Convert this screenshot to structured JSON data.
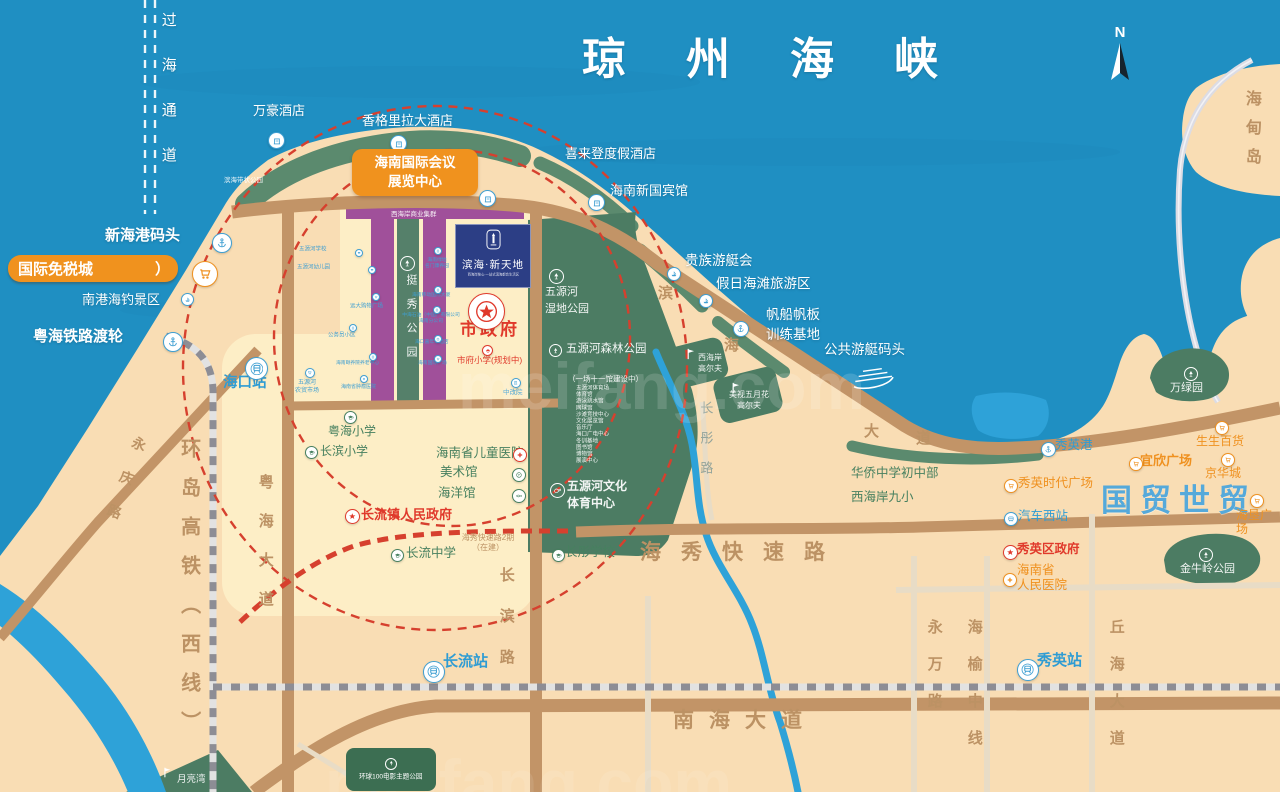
{
  "colors": {
    "blue": "#3f9fd2",
    "green": "#47805f",
    "og": "#ef9120",
    "red": "#e0392b",
    "white": "#ffffff",
    "sea": "#1f8fc2",
    "land": "#f9ddb4",
    "park": "#4c7c63",
    "purple": "#a0509a",
    "road": "#c29467",
    "accent_orange": "#f0921e"
  },
  "compass": {
    "label": "N"
  },
  "project": {
    "title": "滨海·新天地",
    "tagline": "西海岸核心·一站式滨海都会生活区"
  },
  "badges": {
    "convention": {
      "t": "海南国际会议\n展览中心"
    },
    "dutyfree": {
      "t": "国际免税城",
      "arrow": "）"
    },
    "huanqiu": {
      "t": "环球100电影主题公园"
    }
  },
  "texts": [
    {
      "n": "qiongzhou-strait",
      "t": "琼州海峡",
      "x": 582,
      "y": 34,
      "s": 44,
      "c": "w",
      "b": 1,
      "ls": 60
    },
    {
      "n": "cross-sea-channel",
      "t": "过海通道",
      "x": 159,
      "y": 12,
      "s": 15,
      "c": "w",
      "v": 1,
      "ls": 30
    },
    {
      "n": "wanhao-hotel",
      "t": "万豪酒店",
      "x": 253,
      "y": 103,
      "s": 13,
      "c": "w"
    },
    {
      "n": "shangri-la-hotel",
      "t": "香格里拉大酒店",
      "x": 362,
      "y": 113,
      "s": 13,
      "c": "w"
    },
    {
      "n": "sheraton-hotel",
      "t": "喜来登度假酒店",
      "x": 565,
      "y": 146,
      "s": 13,
      "c": "w"
    },
    {
      "n": "new-guobin-hotel",
      "t": "海南新国宾馆",
      "x": 610,
      "y": 183,
      "s": 13,
      "c": "w"
    },
    {
      "n": "binhai-belt-park",
      "t": "滨海带状公园",
      "x": 224,
      "y": 176,
      "s": 6.5,
      "c": "wt"
    },
    {
      "n": "xinhai-port",
      "t": "新海港码头",
      "x": 105,
      "y": 227,
      "s": 15,
      "c": "w",
      "b": 1
    },
    {
      "n": "nangang-fishing-area",
      "t": "南港海钓景区",
      "x": 82,
      "y": 292,
      "s": 13,
      "c": "w"
    },
    {
      "n": "yuehai-rail-ferry",
      "t": "粤海铁路渡轮",
      "x": 33,
      "y": 328,
      "s": 15,
      "c": "w",
      "b": 1
    },
    {
      "n": "haikou-station",
      "t": "海口站",
      "x": 223,
      "y": 375,
      "s": 14.5,
      "c": "tb",
      "b": 1
    },
    {
      "n": "wuyuanhe-market",
      "t": "五源河\n农贸市场",
      "x": 288,
      "y": 378,
      "s": 6,
      "c": "bl",
      "w": 38,
      "lh": 1.35
    },
    {
      "n": "noble-yacht-club",
      "t": "贵族游艇会",
      "x": 685,
      "y": 253,
      "s": 13.5,
      "c": "w"
    },
    {
      "n": "holiday-beach-area",
      "t": "假日海滩旅游区",
      "x": 716,
      "y": 276,
      "s": 13.5,
      "c": "w"
    },
    {
      "n": "sailing-base",
      "t": "帆船帆板\n训练基地",
      "x": 766,
      "y": 305,
      "s": 13.5,
      "c": "w",
      "lh": 1.5
    },
    {
      "n": "public-yacht-wharf",
      "t": "公共游艇码头",
      "x": 824,
      "y": 342,
      "s": 13.5,
      "c": "w"
    },
    {
      "n": "west-coast-golf",
      "t": "西海岸\n高尔夫",
      "x": 694,
      "y": 352,
      "s": 8,
      "c": "wt",
      "w": 32,
      "lh": 1.4
    },
    {
      "n": "meishi-mayflower-golf",
      "t": "美视五月花\n高尔夫",
      "x": 726,
      "y": 389,
      "s": 8,
      "c": "wt",
      "w": 46,
      "lh": 1.4
    },
    {
      "n": "west-coast-business",
      "t": "西海岸商业集群",
      "x": 391,
      "y": 210,
      "s": 6.5,
      "c": "wt"
    },
    {
      "n": "tingxiu-park",
      "t": "挺秀公园",
      "x": 404,
      "y": 274,
      "s": 11,
      "c": "wt",
      "v": 1,
      "ls": 13
    },
    {
      "n": "wuyuanhe-wetland-park",
      "t": "五源河\n湿地公园",
      "x": 545,
      "y": 284,
      "s": 11,
      "c": "wt",
      "lh": 1.55
    },
    {
      "n": "wuyuanhe-forest-park",
      "t": "五源河森林公园",
      "x": 566,
      "y": 343,
      "s": 11.5,
      "c": "wt"
    },
    {
      "n": "stadium-note",
      "t": "（一场十一馆建设中）",
      "x": 568,
      "y": 375,
      "s": 7.5,
      "c": "wt"
    },
    {
      "n": "stadium-list",
      "t": "五源河体育场\n体育馆\n游泳跳水馆\n网球馆\n沙滩竞技中心\n文化展览馆\n音乐厅\n海口广电中心\n冬训基地\n图书馆\n博物馆\n展演中心",
      "x": 576,
      "y": 385,
      "s": 5.5,
      "c": "wt",
      "lh": 1.2
    },
    {
      "n": "wenti-center",
      "t": "五源河文化\n体育中心",
      "x": 567,
      "y": 478,
      "s": 12,
      "c": "wt",
      "b": 1,
      "lh": 1.45
    },
    {
      "n": "city-government",
      "t": "市政府",
      "x": 460,
      "y": 320,
      "s": 17,
      "c": "rd",
      "b": 1,
      "ls": 3
    },
    {
      "n": "shifu-primary",
      "t": "市府小学(规划中)",
      "x": 457,
      "y": 355,
      "s": 8.5,
      "c": "rd"
    },
    {
      "n": "zhonggaiyuan",
      "t": "中改院",
      "x": 503,
      "y": 388,
      "s": 6.5,
      "c": "bl"
    },
    {
      "n": "children-hospital",
      "t": "海南省儿童医院",
      "x": 436,
      "y": 446,
      "s": 12.5,
      "c": "gn"
    },
    {
      "n": "art-museum",
      "t": "美术馆",
      "x": 440,
      "y": 465,
      "s": 12.5,
      "c": "gn"
    },
    {
      "n": "ocean-museum",
      "t": "海洋馆",
      "x": 438,
      "y": 486,
      "s": 12.5,
      "c": "gn"
    },
    {
      "n": "changliu-town-gov",
      "t": "长流镇人民政府",
      "x": 361,
      "y": 507,
      "s": 13,
      "c": "rd",
      "b": 1
    },
    {
      "n": "yuehai-primary",
      "t": "粤海小学",
      "x": 328,
      "y": 424,
      "s": 12,
      "c": "gn"
    },
    {
      "n": "changbin-primary",
      "t": "长滨小学",
      "x": 320,
      "y": 444,
      "s": 12,
      "c": "gn"
    },
    {
      "n": "changliu-middle",
      "t": "长流中学",
      "x": 406,
      "y": 546,
      "s": 12.5,
      "c": "gn"
    },
    {
      "n": "changtong-school",
      "t": "长彤学校",
      "x": 565,
      "y": 545,
      "s": 12.5,
      "c": "gn"
    },
    {
      "n": "haixiu-phase2",
      "t": "海秀快速路2期\n（在建）",
      "x": 452,
      "y": 533,
      "s": 8,
      "c": "br",
      "w": 72,
      "lh": 1.3
    },
    {
      "n": "haixiu-expressway",
      "t": "海秀快速路",
      "x": 640,
      "y": 541,
      "s": 21,
      "c": "brb",
      "ls": 20
    },
    {
      "n": "nanhai-avenue",
      "t": "南海大道",
      "x": 673,
      "y": 709,
      "s": 21,
      "c": "brb",
      "ls": 15
    },
    {
      "n": "changbin-road",
      "t": "长滨路",
      "x": 497,
      "y": 567,
      "s": 15,
      "c": "brb",
      "v": 1,
      "ls": 26
    },
    {
      "n": "yuehai-avenue",
      "t": "粤海大道",
      "x": 256,
      "y": 474,
      "s": 15,
      "c": "brb",
      "v": 1,
      "ls": 24
    },
    {
      "n": "ring-hsr-west-line",
      "t": "环岛高铁（西线）",
      "x": 176,
      "y": 438,
      "s": 20,
      "c": "brb",
      "v": 1,
      "ls": 19
    },
    {
      "n": "yongqing-road",
      "t": "永庆路",
      "x": 133,
      "y": 437,
      "s": 14,
      "c": "brb",
      "v": 1,
      "ls": 22,
      "r": 20
    },
    {
      "n": "changtong-road",
      "t": "长彤路",
      "x": 698,
      "y": 401,
      "s": 13,
      "c": "gb",
      "v": 1,
      "ls": 17
    },
    {
      "n": "changliu-station",
      "t": "长流站",
      "x": 443,
      "y": 653,
      "s": 15,
      "c": "tb",
      "b": 1
    },
    {
      "n": "xiuying-station",
      "t": "秀英站",
      "x": 1037,
      "y": 652,
      "s": 15,
      "c": "tb",
      "b": 1
    },
    {
      "n": "yongwan-road",
      "t": "永万路",
      "x": 925,
      "y": 619,
      "s": 15,
      "c": "brb",
      "v": 1,
      "ls": 22
    },
    {
      "n": "haiyu-mid-line",
      "t": "海榆中线",
      "x": 965,
      "y": 619,
      "s": 15,
      "c": "brb",
      "v": 1,
      "ls": 22
    },
    {
      "n": "qiuhai-avenue",
      "t": "丘海大道",
      "x": 1107,
      "y": 619,
      "s": 15,
      "c": "brb",
      "v": 1,
      "ls": 22
    },
    {
      "n": "guomao-shimao",
      "t": "国贸世贸",
      "x": 1101,
      "y": 483,
      "s": 31,
      "c": "lb",
      "b": 1,
      "ls": 8
    },
    {
      "n": "shengsheng-mall",
      "t": "生生百货",
      "x": 1196,
      "y": 434,
      "s": 12,
      "c": "og"
    },
    {
      "n": "jinghua-city",
      "t": "京华城",
      "x": 1205,
      "y": 466,
      "s": 12,
      "c": "og"
    },
    {
      "n": "haiken-plaza",
      "t": "海垦广场",
      "x": 1236,
      "y": 508,
      "s": 12,
      "c": "og"
    },
    {
      "n": "yixin-plaza",
      "t": "宜欣广场",
      "x": 1140,
      "y": 453,
      "s": 13,
      "c": "og",
      "b": 1
    },
    {
      "n": "xiuying-port",
      "t": "秀英港",
      "x": 1055,
      "y": 438,
      "s": 12.5,
      "c": "tb"
    },
    {
      "n": "xiuying-times-plaza",
      "t": "秀英时代广场",
      "x": 1018,
      "y": 476,
      "s": 12.5,
      "c": "og"
    },
    {
      "n": "west-bus-station",
      "t": "汽车西站",
      "x": 1018,
      "y": 509,
      "s": 12.5,
      "c": "tb"
    },
    {
      "n": "xiuying-district-gov",
      "t": "秀英区政府",
      "x": 1017,
      "y": 542,
      "s": 12.5,
      "c": "rd",
      "b": 1
    },
    {
      "n": "province-people-hospital",
      "t": "海南省\n人民医院",
      "x": 1017,
      "y": 563,
      "s": 12.5,
      "c": "og",
      "lh": 1.2
    },
    {
      "n": "jinniuling-park",
      "t": "金牛岭公园",
      "x": 1180,
      "y": 563,
      "s": 11,
      "c": "wt"
    },
    {
      "n": "wanlv-park",
      "t": "万绿园",
      "x": 1170,
      "y": 382,
      "s": 11,
      "c": "wt"
    },
    {
      "n": "haidian-island",
      "t": "海甸岛",
      "x": 1241,
      "y": 90,
      "s": 16,
      "c": "brb",
      "v": 1,
      "ls": 13
    },
    {
      "n": "huaqiao-middle-school",
      "t": "华侨中学初中部",
      "x": 851,
      "y": 466,
      "s": 12.5,
      "c": "gn"
    },
    {
      "n": "west-coast-9th-primary",
      "t": "西海岸九小",
      "x": 851,
      "y": 490,
      "s": 12.5,
      "c": "gn"
    },
    {
      "n": "yueliang-bay",
      "t": "月亮湾",
      "x": 177,
      "y": 774,
      "s": 9.5,
      "c": "wt"
    },
    {
      "n": "binhai-ave-char1",
      "t": "滨",
      "x": 658,
      "y": 285,
      "s": 15,
      "c": "brb"
    },
    {
      "n": "binhai-ave-char2",
      "t": "海",
      "x": 724,
      "y": 337,
      "s": 15,
      "c": "brb"
    },
    {
      "n": "binhai-ave-char3",
      "t": "大",
      "x": 864,
      "y": 423,
      "s": 15,
      "c": "brb"
    },
    {
      "n": "binhai-ave-char4",
      "t": "道",
      "x": 916,
      "y": 430,
      "s": 15,
      "c": "brb"
    },
    {
      "n": "wuyuanhe-school",
      "t": "五源河学校",
      "x": 299,
      "y": 246,
      "s": 5.5,
      "c": "bl"
    },
    {
      "n": "wuyuanhe-kindergarten",
      "t": "五源河幼儿园",
      "x": 297,
      "y": 264,
      "s": 5.5,
      "c": "bl"
    },
    {
      "n": "yuanda-mall",
      "t": "远大购物广场",
      "x": 350,
      "y": 303,
      "s": 5.5,
      "c": "bl"
    },
    {
      "n": "civil-servant-community",
      "t": "公务员小区",
      "x": 328,
      "y": 332,
      "s": 5.5,
      "c": "bl"
    },
    {
      "n": "nursing-center",
      "t": "海南颐养院养老中心",
      "x": 336,
      "y": 360,
      "s": 4.8,
      "c": "bl"
    },
    {
      "n": "tumor-hospital",
      "t": "海南省肿瘤医院",
      "x": 341,
      "y": 384,
      "s": 5,
      "c": "bl"
    },
    {
      "n": "strip-label-1",
      "t": "海南绿地\n名门康养园",
      "x": 419,
      "y": 257,
      "s": 4.8,
      "c": "bl",
      "w": 36,
      "lh": 1.3
    },
    {
      "n": "strip-label-2",
      "t": "海南移动国际大厦",
      "x": 412,
      "y": 292,
      "s": 4.8,
      "c": "bl"
    },
    {
      "n": "strip-label-3",
      "t": "中海石油（中国）有限公司\n海南分公司",
      "x": 400,
      "y": 312,
      "s": 4.8,
      "c": "bl",
      "w": 62,
      "lh": 1.3
    },
    {
      "n": "strip-label-4",
      "t": "海口嘉年华酒店",
      "x": 415,
      "y": 339,
      "s": 4.8,
      "c": "bl"
    },
    {
      "n": "strip-label-5",
      "t": "海南国际广场",
      "x": 418,
      "y": 360,
      "s": 4.8,
      "c": "bl"
    },
    {
      "n": "watermark-1",
      "t": "meifang.com",
      "x": 458,
      "y": 348,
      "s": 66,
      "c": "wm"
    },
    {
      "n": "watermark-2",
      "t": "meifang.com",
      "x": 325,
      "y": 745,
      "s": 66,
      "c": "wm2"
    }
  ],
  "icons": [
    {
      "n": "marriott-hotel",
      "type": "hotel",
      "x": 268,
      "y": 132,
      "sz": 17,
      "c": "blue"
    },
    {
      "n": "shangrila-hotel",
      "type": "hotel",
      "x": 390,
      "y": 135,
      "sz": 17,
      "c": "blue"
    },
    {
      "n": "sheraton-hotel",
      "type": "hotel",
      "x": 437,
      "y": 156,
      "sz": 17,
      "c": "blue"
    },
    {
      "n": "coast-hotel",
      "type": "hotel",
      "x": 479,
      "y": 190,
      "sz": 17,
      "c": "blue"
    },
    {
      "n": "guobin-hotel",
      "type": "hotel",
      "x": 588,
      "y": 194,
      "sz": 17,
      "c": "blue"
    },
    {
      "n": "xinhai-port-anchor",
      "type": "anchor",
      "x": 212,
      "y": 233,
      "sz": 20,
      "c": "blue"
    },
    {
      "n": "dutyfree-cart",
      "type": "cart",
      "x": 192,
      "y": 261,
      "sz": 26,
      "c": "og"
    },
    {
      "n": "fishing-area",
      "type": "boat",
      "x": 181,
      "y": 293,
      "sz": 13,
      "c": "blue"
    },
    {
      "n": "ferry-anchor",
      "type": "anchor",
      "x": 163,
      "y": 332,
      "sz": 20,
      "c": "blue"
    },
    {
      "n": "haikou-station",
      "type": "train",
      "x": 245,
      "y": 357,
      "sz": 23,
      "c": "blue"
    },
    {
      "n": "market",
      "type": "cart",
      "x": 305,
      "y": 368,
      "sz": 10,
      "c": "blue"
    },
    {
      "n": "tingxiu-tree",
      "type": "tree",
      "x": 400,
      "y": 256,
      "sz": 15,
      "c": "white",
      "v": "ring"
    },
    {
      "n": "wetland-tree",
      "type": "tree",
      "x": 549,
      "y": 269,
      "sz": 15,
      "c": "white",
      "v": "ring"
    },
    {
      "n": "forest-tree",
      "type": "tree",
      "x": 549,
      "y": 344,
      "sz": 13,
      "c": "white",
      "v": "ring"
    },
    {
      "n": "sports-center",
      "type": "sport",
      "x": 550,
      "y": 483,
      "sz": 15,
      "c": "white",
      "v": "ring"
    },
    {
      "n": "yuehai-primary",
      "type": "cap",
      "x": 344,
      "y": 411,
      "sz": 13,
      "c": "green"
    },
    {
      "n": "changbin-primary",
      "type": "cap",
      "x": 305,
      "y": 446,
      "sz": 13,
      "c": "green"
    },
    {
      "n": "changliu-gov-star",
      "type": "star",
      "x": 345,
      "y": 509,
      "sz": 15,
      "c": "red"
    },
    {
      "n": "changliu-middle",
      "type": "cap",
      "x": 391,
      "y": 549,
      "sz": 13,
      "c": "green"
    },
    {
      "n": "changtong-school",
      "type": "cap",
      "x": 552,
      "y": 549,
      "sz": 13,
      "c": "green"
    },
    {
      "n": "children-hospital-cross",
      "type": "cross",
      "x": 513,
      "y": 448,
      "sz": 14,
      "c": "red"
    },
    {
      "n": "art-museum",
      "type": "art",
      "x": 512,
      "y": 468,
      "sz": 14,
      "c": "green"
    },
    {
      "n": "ocean-museum",
      "type": "fish",
      "x": 512,
      "y": 489,
      "sz": 14,
      "c": "green"
    },
    {
      "n": "city-gov-star",
      "type": "govstar",
      "x": 468,
      "y": 293,
      "sz": 37,
      "c": "red"
    },
    {
      "n": "shifu-primary",
      "type": "cap",
      "x": 482,
      "y": 345,
      "sz": 11,
      "c": "red"
    },
    {
      "n": "zhonggaiyuan",
      "type": "building",
      "x": 511,
      "y": 378,
      "sz": 10,
      "c": "blue"
    },
    {
      "n": "strip-school",
      "type": "cap",
      "x": 355,
      "y": 249,
      "sz": 8,
      "c": "blue"
    },
    {
      "n": "strip-kindergarten",
      "type": "cap",
      "x": 368,
      "y": 266,
      "sz": 8,
      "c": "blue"
    },
    {
      "n": "strip-mall",
      "type": "cart",
      "x": 372,
      "y": 293,
      "sz": 8,
      "c": "blue"
    },
    {
      "n": "strip-community",
      "type": "building",
      "x": 349,
      "y": 324,
      "sz": 8,
      "c": "blue"
    },
    {
      "n": "strip-nursing",
      "type": "building",
      "x": 369,
      "y": 353,
      "sz": 8,
      "c": "blue"
    },
    {
      "n": "strip-hospital",
      "type": "cross",
      "x": 360,
      "y": 375,
      "sz": 8,
      "c": "blue"
    },
    {
      "n": "strip-r1",
      "type": "building",
      "x": 434,
      "y": 247,
      "sz": 8,
      "c": "blue"
    },
    {
      "n": "strip-r2",
      "type": "building",
      "x": 434,
      "y": 286,
      "sz": 8,
      "c": "blue"
    },
    {
      "n": "strip-r3",
      "type": "building",
      "x": 433,
      "y": 306,
      "sz": 8,
      "c": "blue"
    },
    {
      "n": "strip-r4",
      "type": "hotel",
      "x": 434,
      "y": 335,
      "sz": 8,
      "c": "blue"
    },
    {
      "n": "strip-r5",
      "type": "cart",
      "x": 434,
      "y": 355,
      "sz": 8,
      "c": "blue"
    },
    {
      "n": "sailing-anchor",
      "type": "anchor",
      "x": 733,
      "y": 321,
      "sz": 16,
      "c": "blue"
    },
    {
      "n": "yacht-club",
      "type": "boat",
      "x": 667,
      "y": 267,
      "sz": 14,
      "c": "blue"
    },
    {
      "n": "holiday-beach",
      "type": "boat",
      "x": 699,
      "y": 294,
      "sz": 14,
      "c": "blue"
    },
    {
      "n": "west-coast-golf-flag",
      "type": "golfflag",
      "x": 684,
      "y": 347,
      "sz": 14,
      "c": "white",
      "v": "plain"
    },
    {
      "n": "meishi-golf-flag",
      "type": "golfflag",
      "x": 729,
      "y": 381,
      "sz": 14,
      "c": "white",
      "v": "plain"
    },
    {
      "n": "yueliang-golf-flag",
      "type": "golfflag",
      "x": 161,
      "y": 766,
      "sz": 13,
      "c": "white",
      "v": "plain"
    },
    {
      "n": "public-yacht",
      "type": "yacht",
      "x": 850,
      "y": 365,
      "sz": 26,
      "wd": 46,
      "c": "white",
      "v": "plain",
      "r": -8
    },
    {
      "n": "changliu-station",
      "type": "train",
      "x": 423,
      "y": 661,
      "sz": 22,
      "c": "blue"
    },
    {
      "n": "xiuying-station",
      "type": "train",
      "x": 1017,
      "y": 659,
      "sz": 22,
      "c": "blue"
    },
    {
      "n": "xiuying-port-anchor",
      "type": "anchor",
      "x": 1041,
      "y": 442,
      "sz": 15,
      "c": "blue"
    },
    {
      "n": "times-plaza",
      "type": "cart",
      "x": 1004,
      "y": 479,
      "sz": 14,
      "c": "og"
    },
    {
      "n": "west-bus",
      "type": "bus",
      "x": 1004,
      "y": 512,
      "sz": 14,
      "c": "blue"
    },
    {
      "n": "xiuying-gov-star",
      "type": "star",
      "x": 1003,
      "y": 545,
      "sz": 15,
      "c": "red"
    },
    {
      "n": "people-hospital-cross",
      "type": "cross",
      "x": 1003,
      "y": 573,
      "sz": 14,
      "c": "og"
    },
    {
      "n": "yixin-cart",
      "type": "cart",
      "x": 1129,
      "y": 457,
      "sz": 14,
      "c": "og"
    },
    {
      "n": "shengsheng-cart",
      "type": "cart",
      "x": 1215,
      "y": 421,
      "sz": 14,
      "c": "og"
    },
    {
      "n": "jinghua-cart",
      "type": "cart",
      "x": 1221,
      "y": 453,
      "sz": 14,
      "c": "og"
    },
    {
      "n": "haiken-cart",
      "type": "cart",
      "x": 1250,
      "y": 494,
      "sz": 14,
      "c": "og"
    },
    {
      "n": "wanlv-tree",
      "type": "tree",
      "x": 1184,
      "y": 367,
      "sz": 14,
      "c": "white",
      "v": "ring"
    },
    {
      "n": "jinniuling-tree",
      "type": "tree",
      "x": 1199,
      "y": 548,
      "sz": 14,
      "c": "white",
      "v": "ring"
    }
  ]
}
